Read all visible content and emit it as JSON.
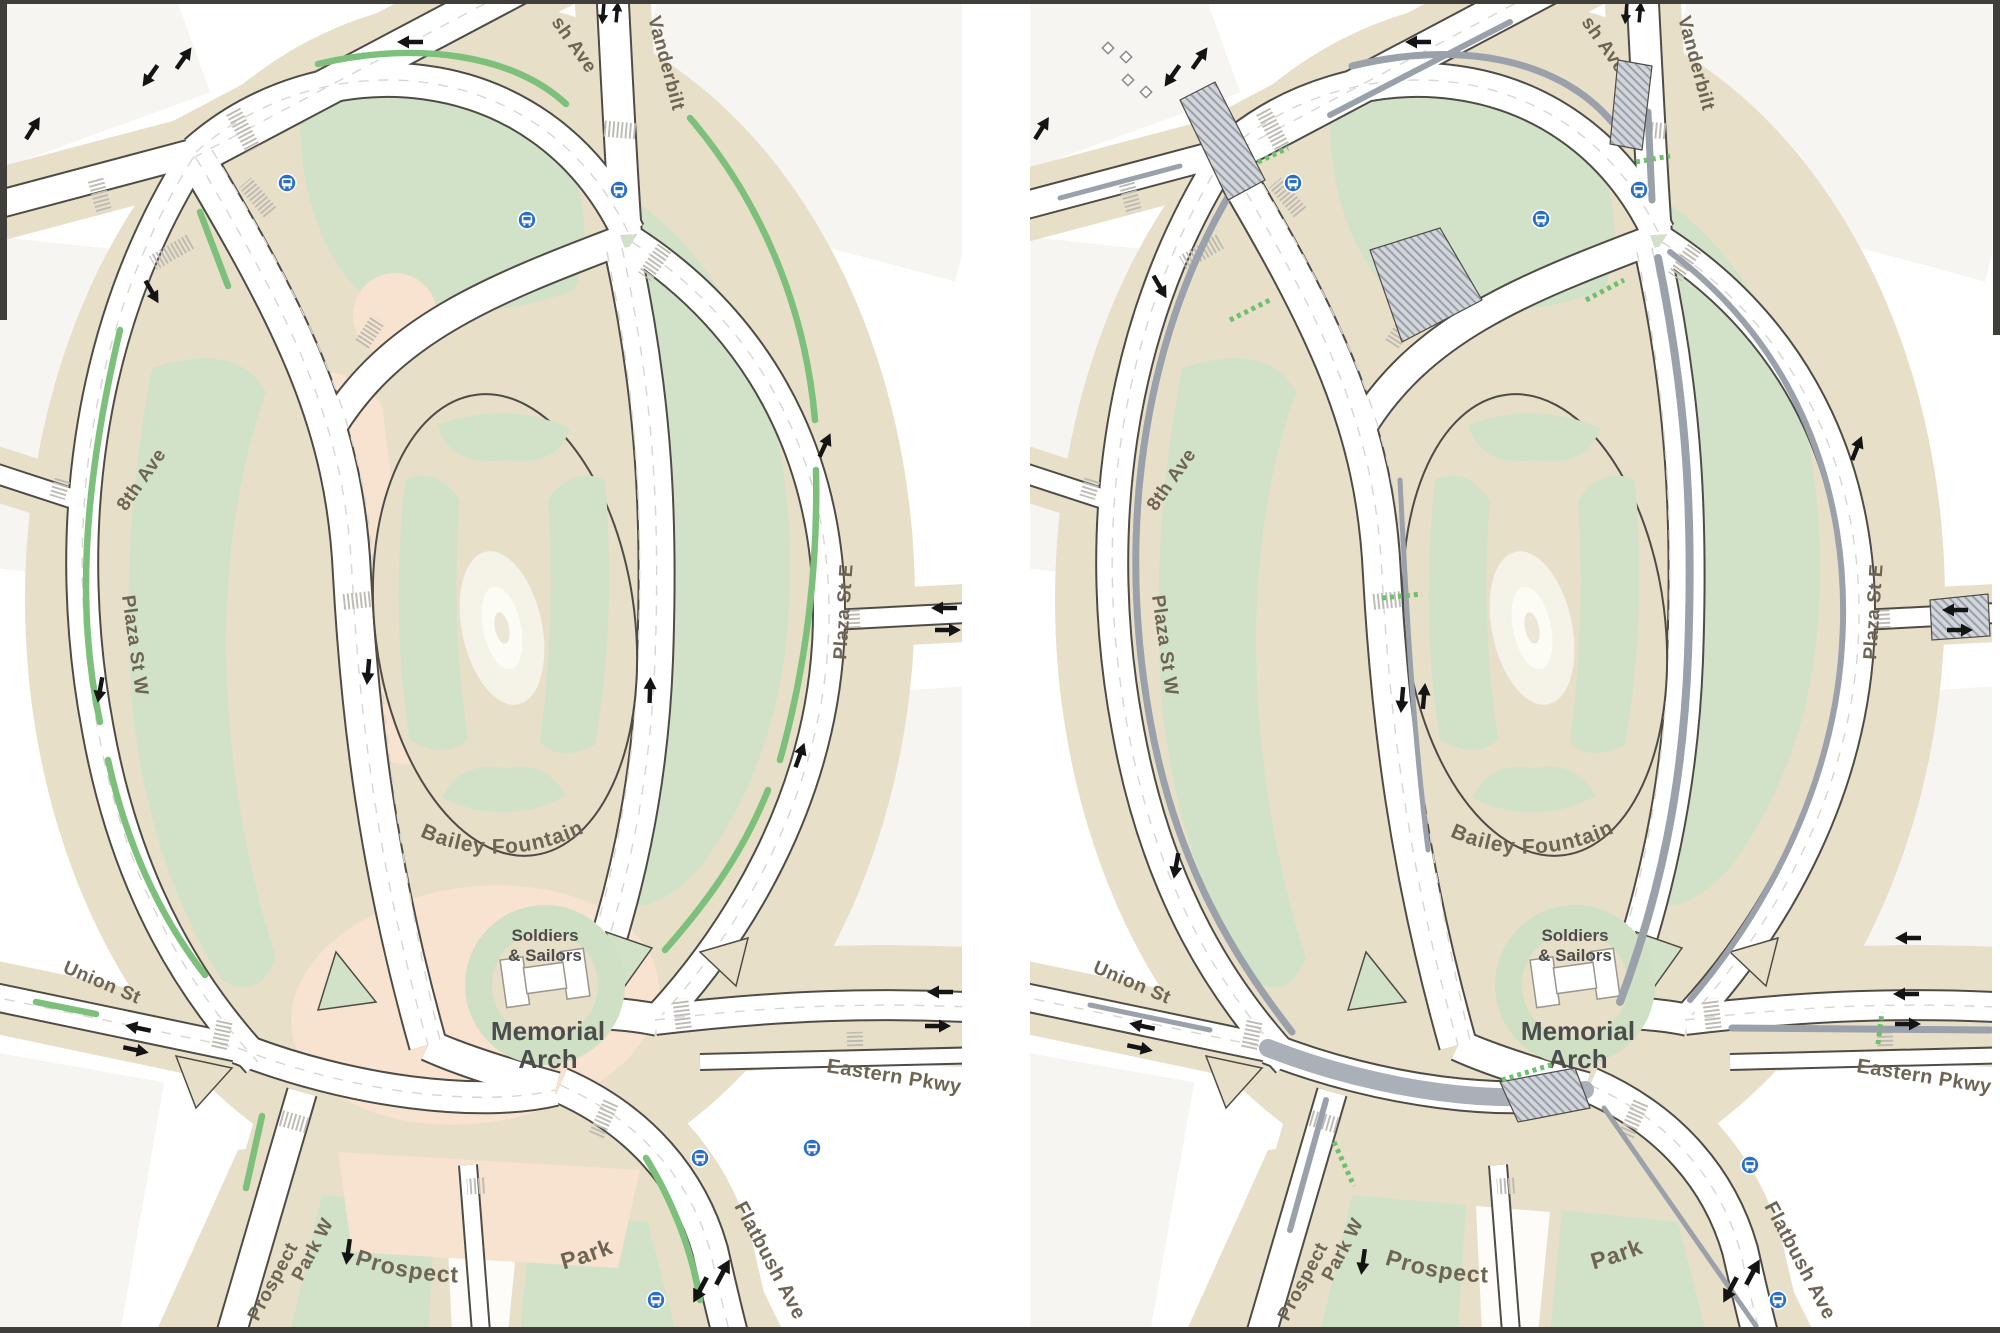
{
  "figure": {
    "panel_count": 2,
    "separator": "white vertical gutter between two map panels"
  },
  "labels": {
    "flatbush_ave_top": "sh Ave",
    "eighth_ave": "8th Ave",
    "vanderbilt_ave": "Vanderbilt",
    "plaza_st_w": "Plaza St W",
    "plaza_st_e": "Plaza St E",
    "bailey_fountain": "Bailey Fountain",
    "soldiers": "Soldiers",
    "sailors": "& Sailors",
    "memorial": "Memorial",
    "arch": "Arch",
    "union_st": "Union St",
    "eastern_pkwy": "Eastern Pkwy",
    "prospect_park_w_line1": "Prospect",
    "prospect_park_w_line2": "Park W",
    "prospect_park_word1": "Prospect",
    "prospect_park_word2": "Park",
    "flatbush_ave_bottom": "Flatbush Ave"
  },
  "icons": {
    "bus_stop_icon": "white bus glyph in blue circle",
    "direction_arrow_icon": "black one-way traffic arrow",
    "bike_lane_marking": "green lane stripe",
    "crosswalk_marking": "striped pedestrian crosswalk",
    "shared_lane_diamond": "small white diamond pavement marking",
    "hatched_median": "gray cross-hatched pedestrian island"
  },
  "colors": {
    "background": "#ffffff",
    "city_block": "#f6f5f1",
    "sidewalk_tan": "#e8dfc9",
    "park_green": "#d2e2c8",
    "plaza_peach": "#f7e3cf",
    "road_fill": "#ffffff",
    "road_casing": "#4f4c46",
    "lane_line": "#d8d6d0",
    "bike_lane_green": "#7cc07c",
    "median_gray": "#9aa1ab",
    "crosswalk_gray": "#bdbab3",
    "arrow_black": "#141414",
    "bus_stop_blue": "#2a6fc5",
    "street_label_brown": "#6e6453",
    "arch_label_gray": "#4c4c4c",
    "fountain_white": "#f5f3e8"
  }
}
